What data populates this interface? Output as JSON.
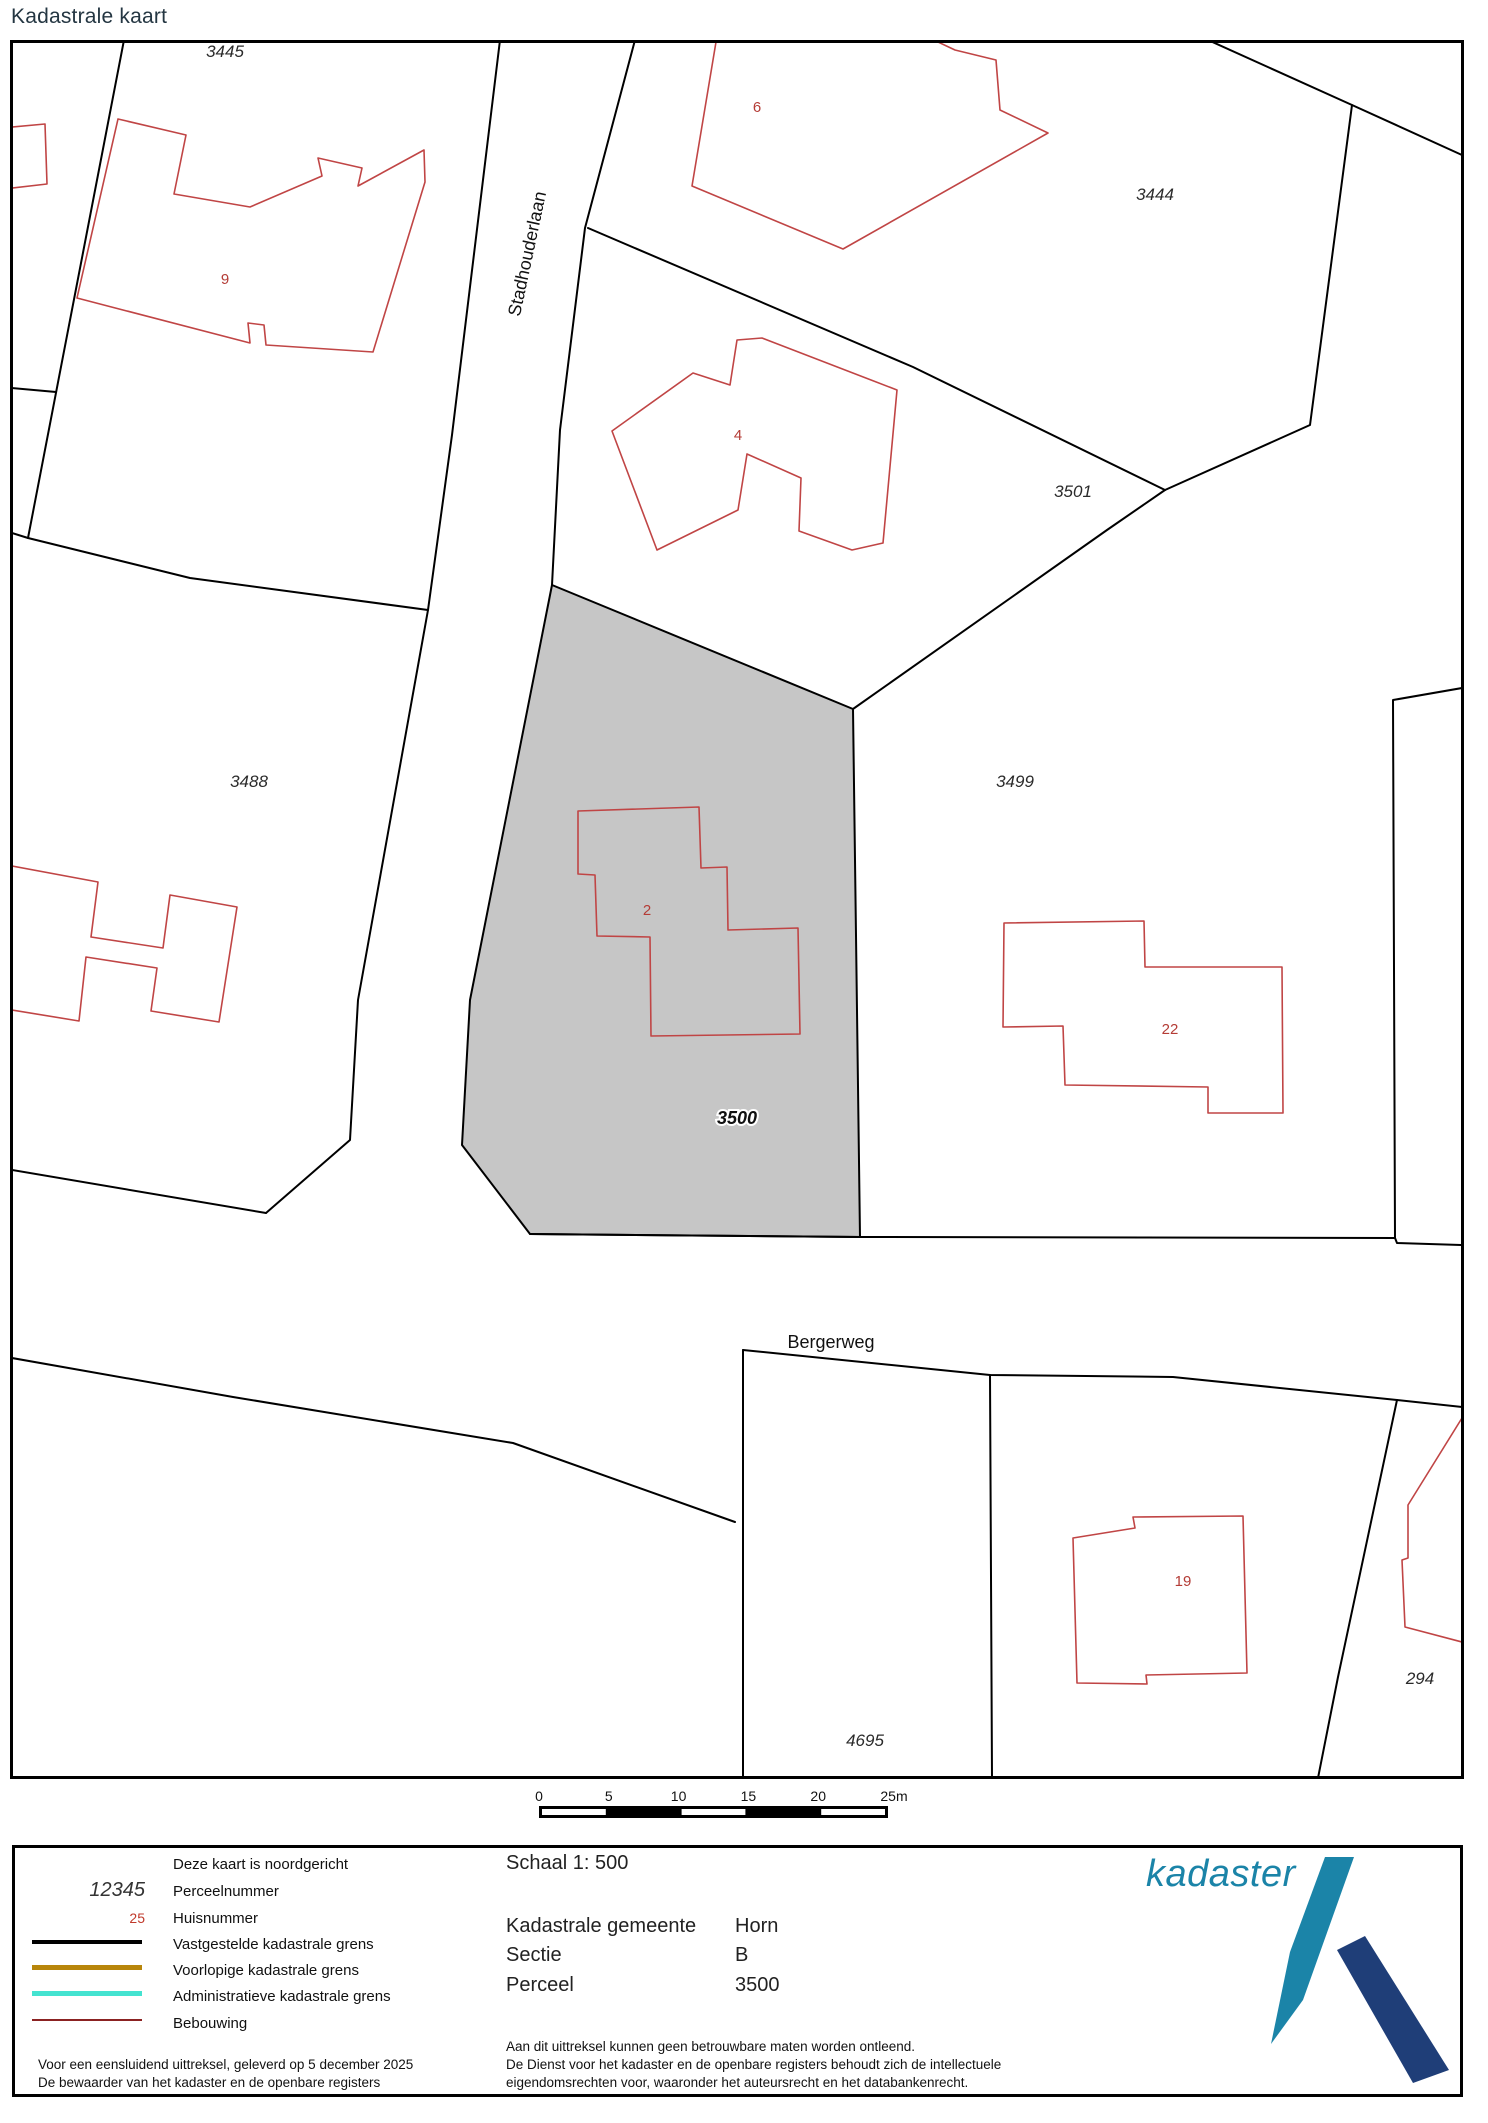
{
  "page": {
    "title": "Kadastrale kaart"
  },
  "map": {
    "street_labels": [
      {
        "text": "Stadhouderlaan"
      },
      {
        "text": "Bergerweg"
      }
    ],
    "parcel_labels": [
      {
        "text": "3445"
      },
      {
        "text": "3444"
      },
      {
        "text": "3501"
      },
      {
        "text": "3488"
      },
      {
        "text": "3499"
      },
      {
        "text": "3500",
        "highlighted": true
      },
      {
        "text": "4695"
      },
      {
        "text": "294"
      }
    ],
    "house_numbers": [
      {
        "text": "9"
      },
      {
        "text": "6"
      },
      {
        "text": "4"
      },
      {
        "text": "2"
      },
      {
        "text": "22"
      },
      {
        "text": "19"
      }
    ],
    "colors": {
      "parcel_boundary": "#000000",
      "building_outline": "#c04545",
      "selected_parcel_fill": "#c6c6c6",
      "house_number": "#b43c36"
    }
  },
  "scalebar": {
    "ticks": [
      "0",
      "5",
      "10",
      "15",
      "20",
      "25m"
    ]
  },
  "legend": {
    "items": [
      {
        "symbol": "",
        "label": "Deze kaart is noordgericht"
      },
      {
        "symbol": "12345",
        "label": "Perceelnummer"
      },
      {
        "symbol": "25",
        "label": "Huisnummer"
      },
      {
        "symbol": "line",
        "label": "Vastgestelde kadastrale grens",
        "color": "#000000"
      },
      {
        "symbol": "line",
        "label": "Voorlopige kadastrale grens",
        "color": "#b8860b"
      },
      {
        "symbol": "line",
        "label": "Administratieve kadastrale grens",
        "color": "#44e3d0"
      },
      {
        "symbol": "line",
        "label": "Bebouwing",
        "color": "#8b2222"
      }
    ],
    "footer_lines": [
      "Voor een eensluidend uittreksel, geleverd op 5 december 2025",
      "De bewaarder van het kadaster en de openbare registers"
    ]
  },
  "details": {
    "schaal": "Schaal 1: 500",
    "rows": [
      {
        "label": "Kadastrale gemeente",
        "value": "Horn"
      },
      {
        "label": "Sectie",
        "value": "B"
      },
      {
        "label": "Perceel",
        "value": "3500"
      }
    ],
    "disclaimer_lines": [
      "Aan dit uittreksel kunnen geen betrouwbare maten worden ontleend.",
      "De Dienst voor het kadaster en de openbare registers behoudt zich de intellectuele",
      "eigendomsrechten voor, waaronder het auteursrecht en het databankenrecht."
    ]
  },
  "logo": {
    "text": "kadaster",
    "teal": "#1b84a8",
    "navy": "#1f3e78"
  }
}
